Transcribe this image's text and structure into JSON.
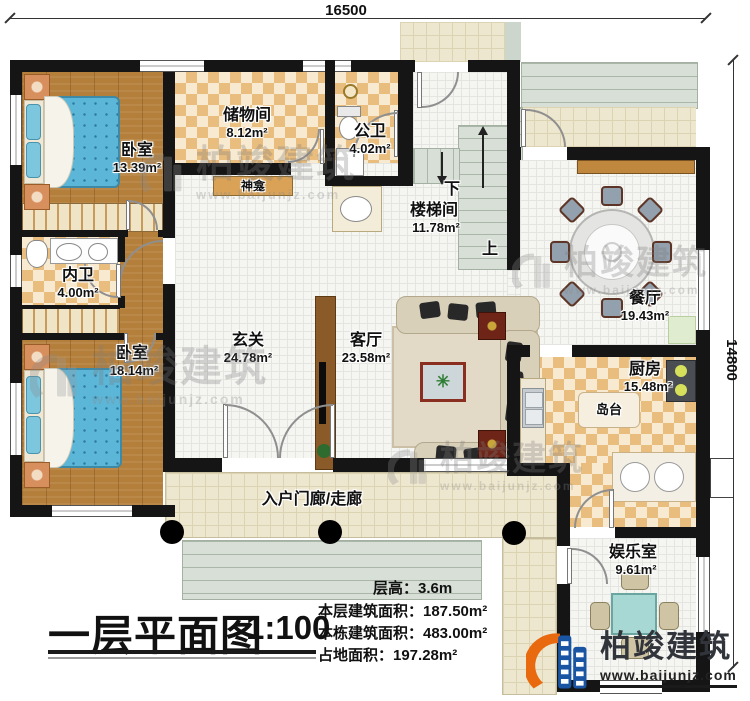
{
  "dimensions": {
    "top": "16500",
    "right": "14800"
  },
  "rooms": {
    "bedroom1": {
      "name": "卧室",
      "area": "13.39m²"
    },
    "storage": {
      "name": "储物间",
      "area": "8.12m²"
    },
    "public_bath": {
      "name": "公卫",
      "area": "4.02m²"
    },
    "stairwell": {
      "name": "楼梯间",
      "area": "11.78m²",
      "down_label": "下",
      "up_label": "上"
    },
    "dining": {
      "name": "餐厅",
      "area": "19.43m²"
    },
    "inner_bath": {
      "name": "内卫",
      "area": "4.00m²"
    },
    "bedroom2": {
      "name": "卧室",
      "area": "18.14m²"
    },
    "foyer": {
      "name": "玄关",
      "area": "24.78m²"
    },
    "living": {
      "name": "客厅",
      "area": "23.58m²"
    },
    "kitchen": {
      "name": "厨房",
      "area": "15.48m²",
      "island_label": "岛台"
    },
    "entertainment": {
      "name": "娱乐室",
      "area": "9.61m²"
    },
    "porch": {
      "name": "入户门廊/走廊"
    },
    "shrine": {
      "name": "神龛"
    }
  },
  "title": {
    "text": "一层平面图",
    "scale": "1:100"
  },
  "stats": {
    "floor_height": "层高：3.6m",
    "floor_area": "本层建筑面积：187.50m²",
    "building_area": "本栋建筑面积：483.00m²",
    "land_area": "占地面积：197.28m²"
  },
  "brand": {
    "name": "柏竣建筑",
    "website": "www.baijunjz.com",
    "logo_icon": "building-logo-icon"
  },
  "watermark": {
    "name": "柏竣建筑",
    "website": "www.baijunjz.com"
  },
  "colors": {
    "wall": "#151515",
    "checker_tile": "#e9bd7d",
    "wood_floor": "#b47f3b",
    "bed": "#5cb6d8",
    "brand_blue": "#1a55a3",
    "brand_orange": "#e9690e"
  }
}
